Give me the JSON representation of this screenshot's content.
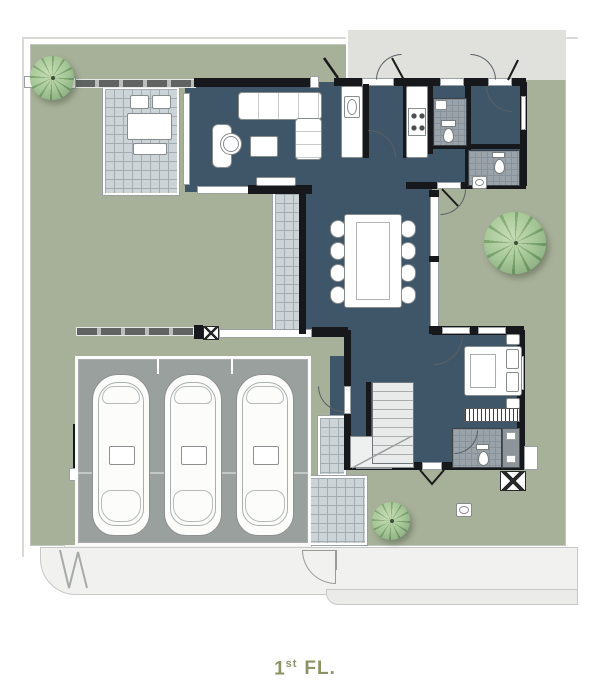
{
  "title": {
    "prefix": "1",
    "ordinal": "st",
    "suffix": "FL."
  },
  "legend": {
    "floor_label": "1st FL.",
    "car_count": 3,
    "tree_count": 3,
    "dining_seat_count": 8
  },
  "colors": {
    "paper": "#ffffff",
    "yard": "#a7b098",
    "slate": "#3f5669",
    "wall": "#16181b",
    "tile": "#ccd4d8",
    "tileline": "#a2acb1",
    "bathtile": "#9aa3a9",
    "bathline": "#89929a",
    "pad": "#9aa09e",
    "band": "#f1f1ef",
    "titlecolor": "#8b9367",
    "treedark": "#6f9a66",
    "treelight": "#bdd6aa",
    "fencedark": "#5f6462",
    "fencelight": "#b9bdbb"
  }
}
